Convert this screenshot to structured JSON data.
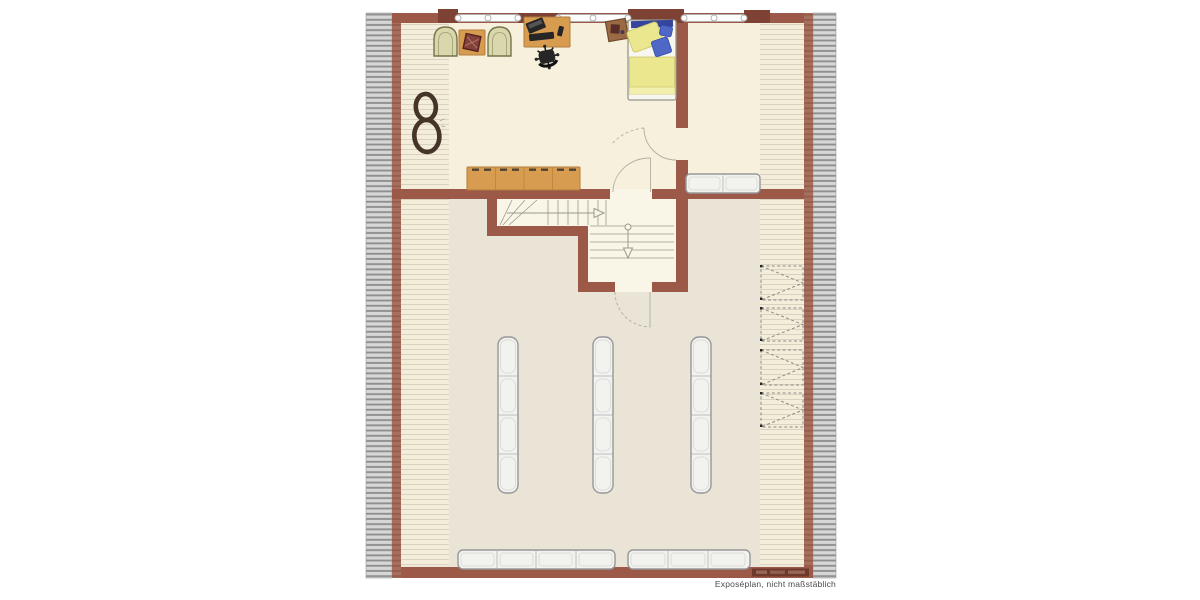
{
  "caption": {
    "text": "Exposéplan, nicht maßstäblich"
  },
  "palette": {
    "bg": "#ffffff",
    "wall": "#9c5948",
    "wall-dark": "#7d4233",
    "knee-bg": "#a7705e",
    "knee-line": "#8a4b3b",
    "hatch-bg": "#d7d7d7",
    "hatch-line": "#8f8f8f",
    "floor-upper": "#f6f0dc",
    "floor-lower": "#e9e4d5",
    "strip-bg": "#f3edda",
    "strip-line": "#d9d2c0",
    "stair-floor": "#faf6e7",
    "tread": "#9b998c",
    "door-arc": "#b3ada0",
    "window-fill": "#fdfdfd",
    "window-border": "#aeaeae",
    "wood": "#d89c50",
    "wood-border": "#b07b38",
    "wood-dark": "#4f4433",
    "furn-white": "#f2f2ef",
    "furn-border": "#97979a",
    "furn-inner": "#dcdcd8",
    "chair-fill": "#d9d7ab",
    "chair-border": "#74744d",
    "bed-frame": "#97968a",
    "mattress": "#f7f6ef",
    "blanket": "#ebe78e",
    "blanket-edge": "#cdc76a",
    "blanket-light": "#f2efac",
    "pillow-blue": "#4f67c6",
    "pillow-blue-edge": "#3950a8",
    "headboard-blue": "#35449c",
    "dark-item": "#262626",
    "eight": "#453529",
    "dash": "#8c8c88",
    "watermark": "#6e382a",
    "caption-color": "#4b4b4b"
  },
  "plan": {
    "type": "floor-plan",
    "rooms": [
      "bedroom-office",
      "landing",
      "attic-main-room",
      "stairwell"
    ],
    "elements": [
      "roof-hatch-left",
      "roof-hatch-right",
      "knee-wall-left",
      "knee-wall-right",
      "window-band",
      "armchair",
      "side-table-with-basket",
      "desk",
      "office-chair",
      "single-bed",
      "nightstand",
      "figure-eight-rug",
      "sideboard",
      "bench-sofa",
      "staircase-upper-flight",
      "staircase-lower-flight",
      "wardrobe-rack",
      "cabinet-row",
      "eaves-storage-box",
      "watermark-band"
    ]
  }
}
